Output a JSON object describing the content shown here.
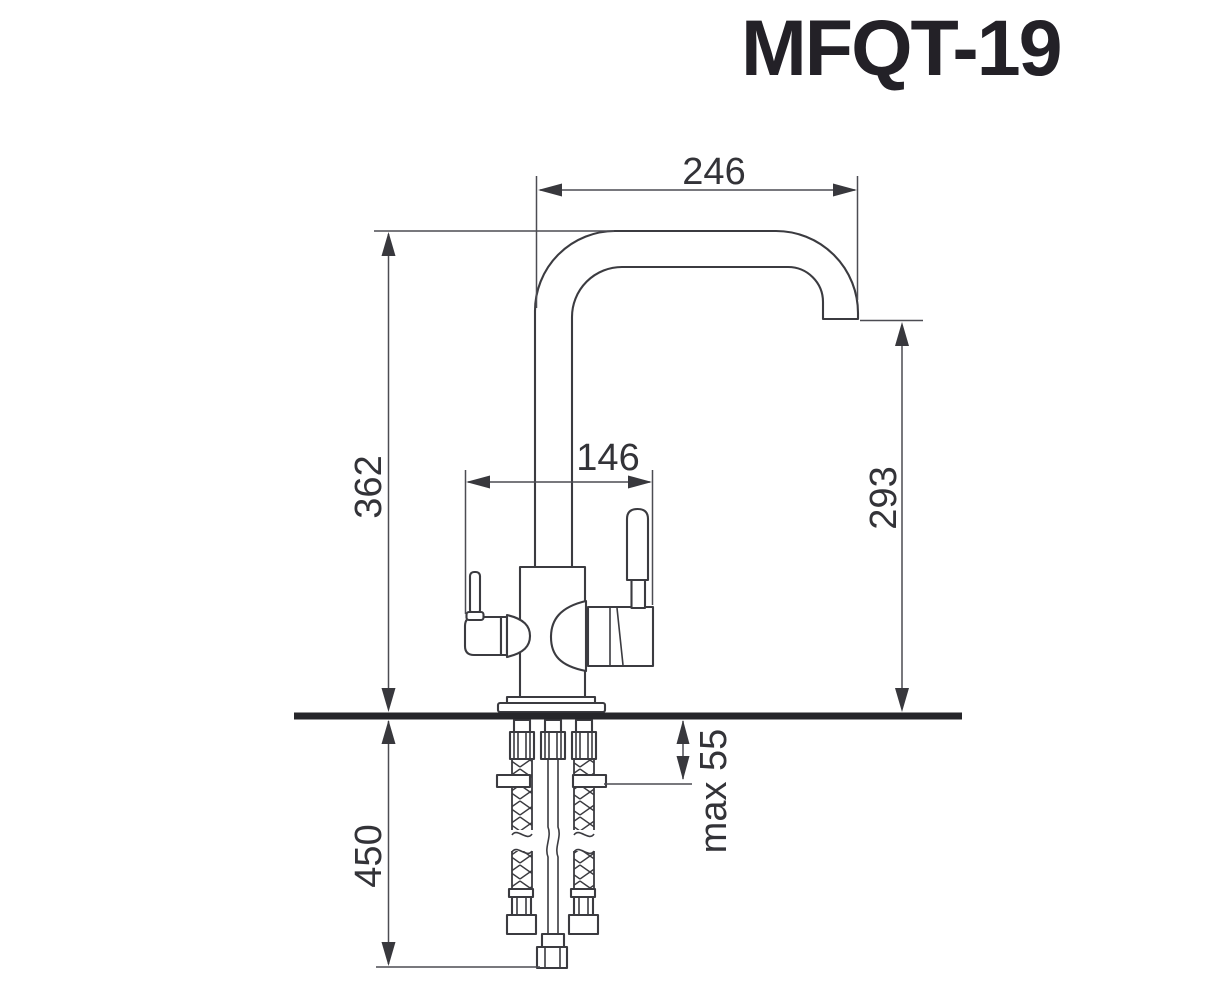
{
  "title": "MFQT-19",
  "dimensions": {
    "spout_reach": "246",
    "spout_top_height": "362",
    "body_span": "146",
    "outlet_height": "293",
    "counter_thickness": "max 55",
    "hose_length": "450"
  },
  "colors": {
    "line": "#3b3b40",
    "dim": "#4c4c52",
    "deck": "#26262a",
    "text": "#333338",
    "title": "#232127",
    "background": "#ffffff"
  }
}
